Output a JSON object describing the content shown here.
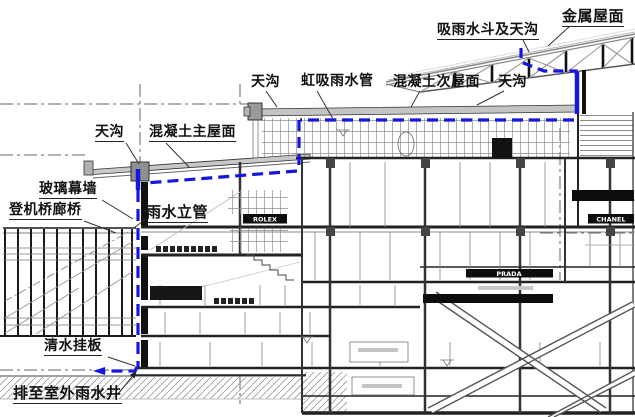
{
  "drawing": {
    "type": "building-section-rainwater-drainage-diagram",
    "labels": {
      "metal_roof": "金属屋面",
      "rain_hopper_gutter": "吸雨水斗及天沟",
      "gutter_top_left": "天沟",
      "siphonic_rain_pipe": "虹吸雨水管",
      "concrete_secondary_roof": "混凝土次屋面",
      "gutter_top_right": "天沟",
      "gutter_left": "天沟",
      "concrete_main_roof": "混凝土主屋面",
      "glass_curtain_wall": "玻璃幕墙",
      "boarding_bridge": "登机桥廊桥",
      "rain_riser": "雨水立管",
      "fairface_panel": "清水挂板",
      "drain_to_outdoor_well": "排至室外雨水井"
    },
    "signs": {
      "shop1": "ROLEX",
      "shop2": "PRADA",
      "shop3": "CHANEL"
    },
    "colors": {
      "pipe_blue": "#1616dd",
      "line_dark": "#2b2b2b",
      "line_gray": "#8a8a8a",
      "roof_fill": "#c8c8c8",
      "ground_hatch": "#9a9a9a"
    }
  }
}
